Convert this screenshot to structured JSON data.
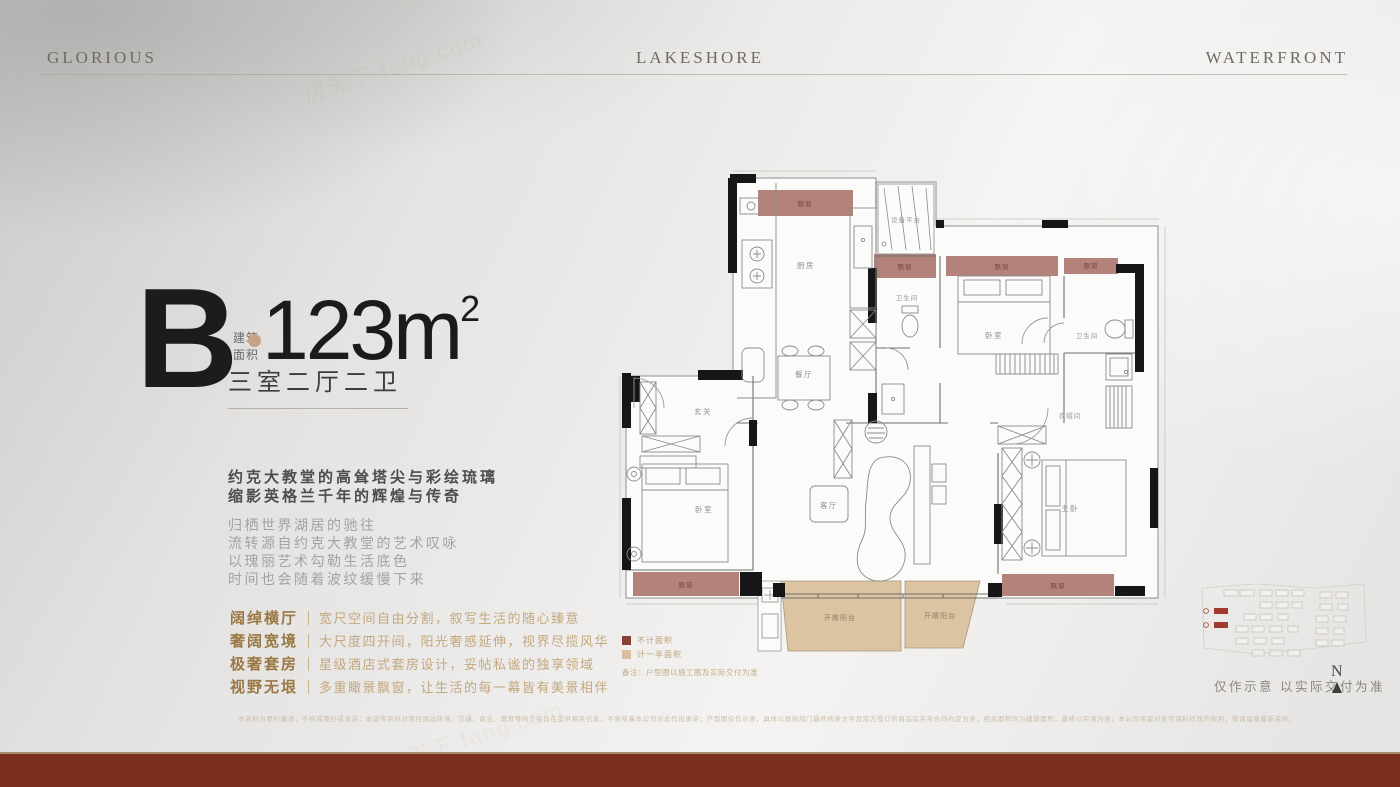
{
  "header": {
    "left": "GLORIOUS",
    "center": "LAKESHORE",
    "right": "WATERFRONT"
  },
  "watermark": "房天下 fang.com",
  "unit": {
    "letter": "B",
    "area_label_line1": "建筑",
    "area_label_line2": "面积",
    "area_value": "123m",
    "area_sup": "2",
    "layout": "三室二厅二卫"
  },
  "intro": {
    "bold_lines": [
      "约克大教堂的高耸塔尖与彩绘琉璃",
      "缩影英格兰千年的辉煌与传奇"
    ],
    "light_lines": [
      "归栖世界湖居的驰往",
      "流转源自约克大教堂的艺术叹咏",
      "以瑰丽艺术勾勒生活底色",
      "时间也会随着波纹缓慢下来"
    ]
  },
  "features": [
    {
      "title": "阔绰横厅",
      "desc": "宽尺空间自由分割，叙写生活的随心臻意"
    },
    {
      "title": "奢阔宽境",
      "desc": "大尺度四开间，阳光奢感延伸，视界尽揽风华"
    },
    {
      "title": "极奢套房",
      "desc": "星级酒店式套房设计，妥帖私谧的独享领域"
    },
    {
      "title": "视野无垠",
      "desc": "多重瞰景飘窗，让生活的每一幕皆有美景相伴"
    }
  ],
  "floorplan": {
    "rooms": {
      "kitchen": "厨房",
      "equipment": "设备平台",
      "bath1": "卫生间",
      "bedroom2": "卧室",
      "bath2": "卫生间",
      "dining": "餐厅",
      "entry": "玄关",
      "bedroom1": "卧室",
      "living": "客厅",
      "master": "主卧",
      "closet": "衣帽间",
      "balcony": "开敞阳台",
      "bay": "飘窗"
    },
    "legend": [
      {
        "color": "#8a4036",
        "label": "不计面积"
      },
      {
        "color": "#d8bfa0",
        "label": "计一半面积"
      }
    ],
    "legend_note": "备注：户型图以施工图及实际交付为准",
    "colors": {
      "bay": "#b3837b",
      "balcony": "#dcc3a1",
      "wall": "#161616"
    }
  },
  "siteplan": {
    "note": "仅作示意 以实际交付为准",
    "compass": "N"
  },
  "footer": {
    "disclaimer": "本资料为要约邀请，不构成要约或承诺；本宣传资料对项目周边环境、交通、商业、教育等的介绍旨在提供相关信息，不意味着本公司对此作出承诺；户型图仅作示意，具体以政府部门最终核准文件及双方签订的商品房买卖合同约定为准；相关面积均为建筑面积，最终以实测为准；本公司保留对宣传资料修改的权利，敬请留意最新资料。",
    "bar_color": "#7c2e1f"
  }
}
